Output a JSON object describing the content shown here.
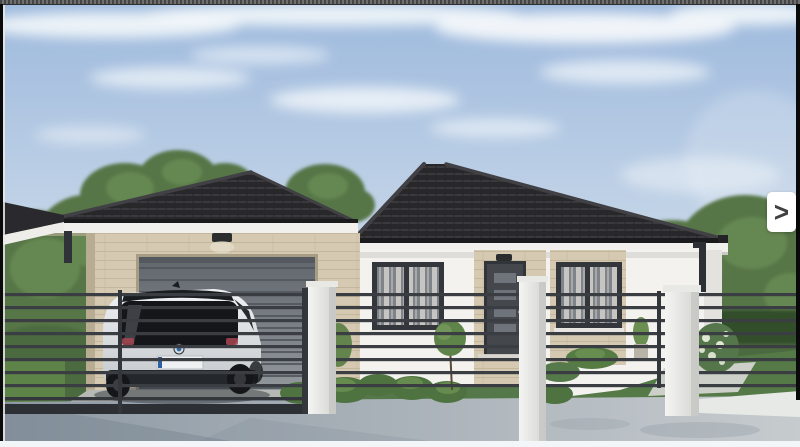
{
  "gallery": {
    "next_button": {
      "label": ">",
      "background": "#ffffff",
      "glyph_color": "#3f4042"
    },
    "frame": {
      "top_stripe_colors": [
        "#454545",
        "#707070"
      ],
      "side_bar_color": "#0a0a0a",
      "bottom_strip_color": "#f3f6f8"
    }
  },
  "photo": {
    "description": "3D architectural rendering of a single-story house with dark hipped tile roof, white walls with beige travertine stone accents, gray sectional garage door, front door with glass panes, two curtained windows, black horizontal-rail fence with white pillars, a white BMW i3 hatchback parked on the paved driveway, lawns, shrubs, trees and a blue sky with clouds",
    "palette": {
      "sky_top": "#9db9dd",
      "sky_horizon": "#e0e8ef",
      "clouds": "#f2f6fa",
      "roof": "#28282b",
      "fascia": "#f1f0ec",
      "wall_white": "#f3f2ee",
      "stone": "#d5cab1",
      "garage_door": "#6a6f76",
      "front_door": "#44474b",
      "window_frame": "#33373b",
      "curtains": "#c7c5c1",
      "fence_rail": "#3a3d41",
      "pillar": "#efefed",
      "trees": "#567647",
      "hedge": "#314d29",
      "grass": "#5d8349",
      "driveway": "#b6b9b4",
      "sidewalk": "#a9b2ba",
      "car_body": "#e6e9eb",
      "car_glass": "#141619"
    }
  }
}
